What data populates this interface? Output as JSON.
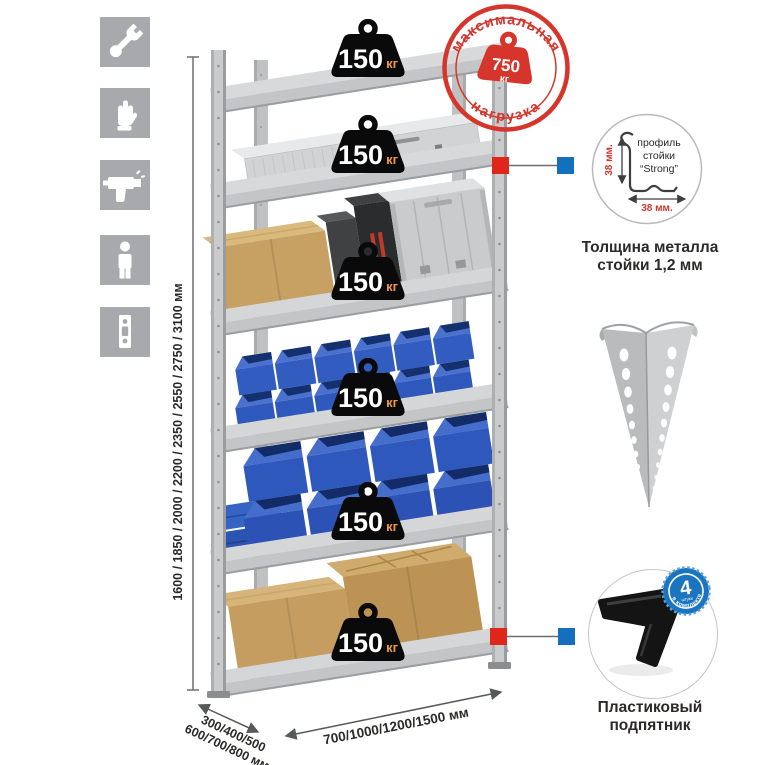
{
  "left_icons": {
    "bg": "#a7a9ac",
    "items": [
      {
        "name": "wrench"
      },
      {
        "name": "gloves"
      },
      {
        "name": "drill"
      },
      {
        "name": "person"
      },
      {
        "name": "rack-post-strip"
      }
    ]
  },
  "dimensions": {
    "height": "1600 / 1850 / 2000 / 2200 / 2350 / 2550 / 2750 / 3100 мм",
    "depth_line1": "300/400/500",
    "depth_line2": "600/700/800 мм",
    "width": "700/1000/1200/1500 мм"
  },
  "shelf_load": {
    "count": 6,
    "value": "150",
    "unit": "кг"
  },
  "max_load_stamp": {
    "arc_top": "максимальная",
    "arc_bottom": "нагрузка",
    "value": "750",
    "unit": "кг",
    "color": "#d5352b"
  },
  "profile_detail": {
    "line1": "профиль",
    "line2": "стойки",
    "line3": "“Strong”",
    "dim_vertical": "38 мм.",
    "dim_horizontal": "38 мм.",
    "caption1": "Толщина металла",
    "caption2": "стойки 1,2 мм"
  },
  "kit_badge": {
    "value": "4",
    "sub": "штуки",
    "arc": "в комплекте",
    "color": "#1a74c0"
  },
  "foot_detail": {
    "caption1": "Пластиковый",
    "caption2": "подпятник"
  },
  "colors": {
    "stamp_red": "#d5352b",
    "callout_red": "#e0251b",
    "callout_blue": "#1470bf",
    "bin_blue": "#3058bd",
    "steel_gray": "#c6c8ca",
    "weight_black": "#0a0a0a",
    "unit_orange": "#ee9a3e",
    "cardboard": "#c59d61"
  }
}
